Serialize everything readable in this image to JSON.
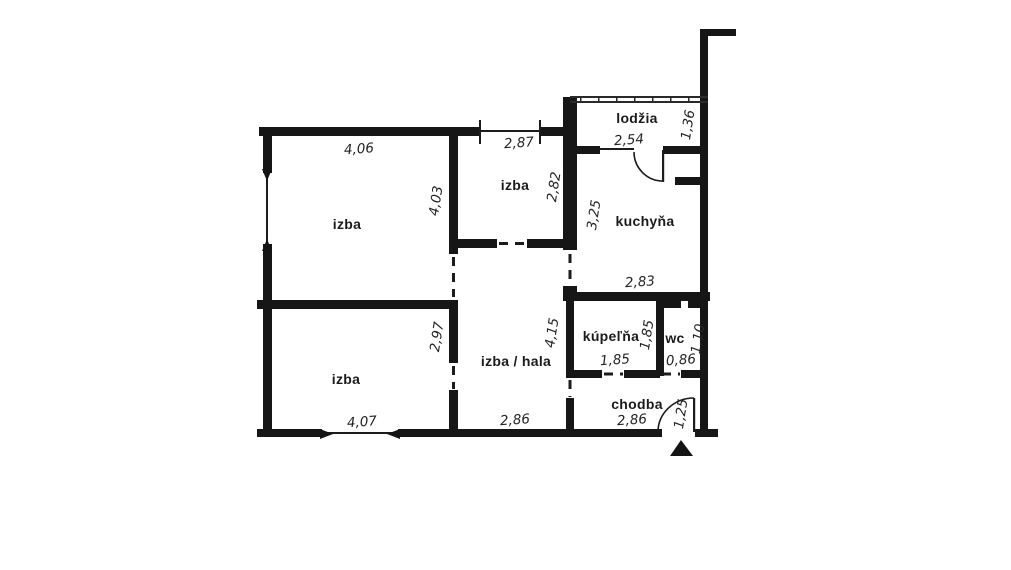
{
  "plan_type": "apartment-floor-plan",
  "language": "sk",
  "colors": {
    "wall": "#161616",
    "background": "#ffffff"
  },
  "rooms": [
    {
      "id": "izba-top-left",
      "name": "izba",
      "width_m": "4,06",
      "height_m": "4,03"
    },
    {
      "id": "izba-middle",
      "name": "izba",
      "width_m": "2,87",
      "height_m": "2,82"
    },
    {
      "id": "lodzia",
      "name": "lodžia",
      "width_m": "2,54",
      "height_m": "1,36"
    },
    {
      "id": "kuchyna",
      "name": "kuchyňa",
      "width_m": "2,83",
      "height_m": "3,25"
    },
    {
      "id": "kupelna",
      "name": "kúpeľňa",
      "width_m": "1,85",
      "height_m": "1,85"
    },
    {
      "id": "wc",
      "name": "wc",
      "width_m": "0,86",
      "height_m": "1,10"
    },
    {
      "id": "izba-bottom-left",
      "name": "izba",
      "width_m": "4,07",
      "height_m": "2,97"
    },
    {
      "id": "izba-hala",
      "name": "izba / hala",
      "width_m": "2,86",
      "height_m": "4,15"
    },
    {
      "id": "chodba",
      "name": "chodba",
      "width_m": "2,86",
      "entrance_door_m": "1,25"
    }
  ]
}
